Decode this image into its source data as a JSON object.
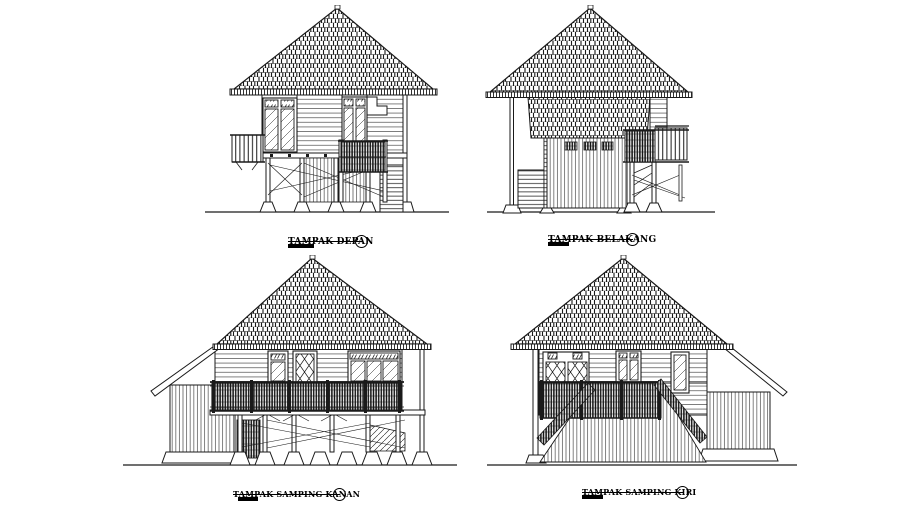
{
  "page": {
    "background": "#ffffff",
    "ink_color": "#1a1a1a",
    "marker_shape": "circle"
  },
  "views": [
    {
      "id": "front",
      "label": "TAMPAK DEPAN"
    },
    {
      "id": "back",
      "label": "TAMPAK BELAKANG"
    },
    {
      "id": "right-side",
      "label": "TAMPAK SAMPING KANAN"
    },
    {
      "id": "left-side",
      "label": "TAMPAK SAMPING KIRI"
    }
  ]
}
